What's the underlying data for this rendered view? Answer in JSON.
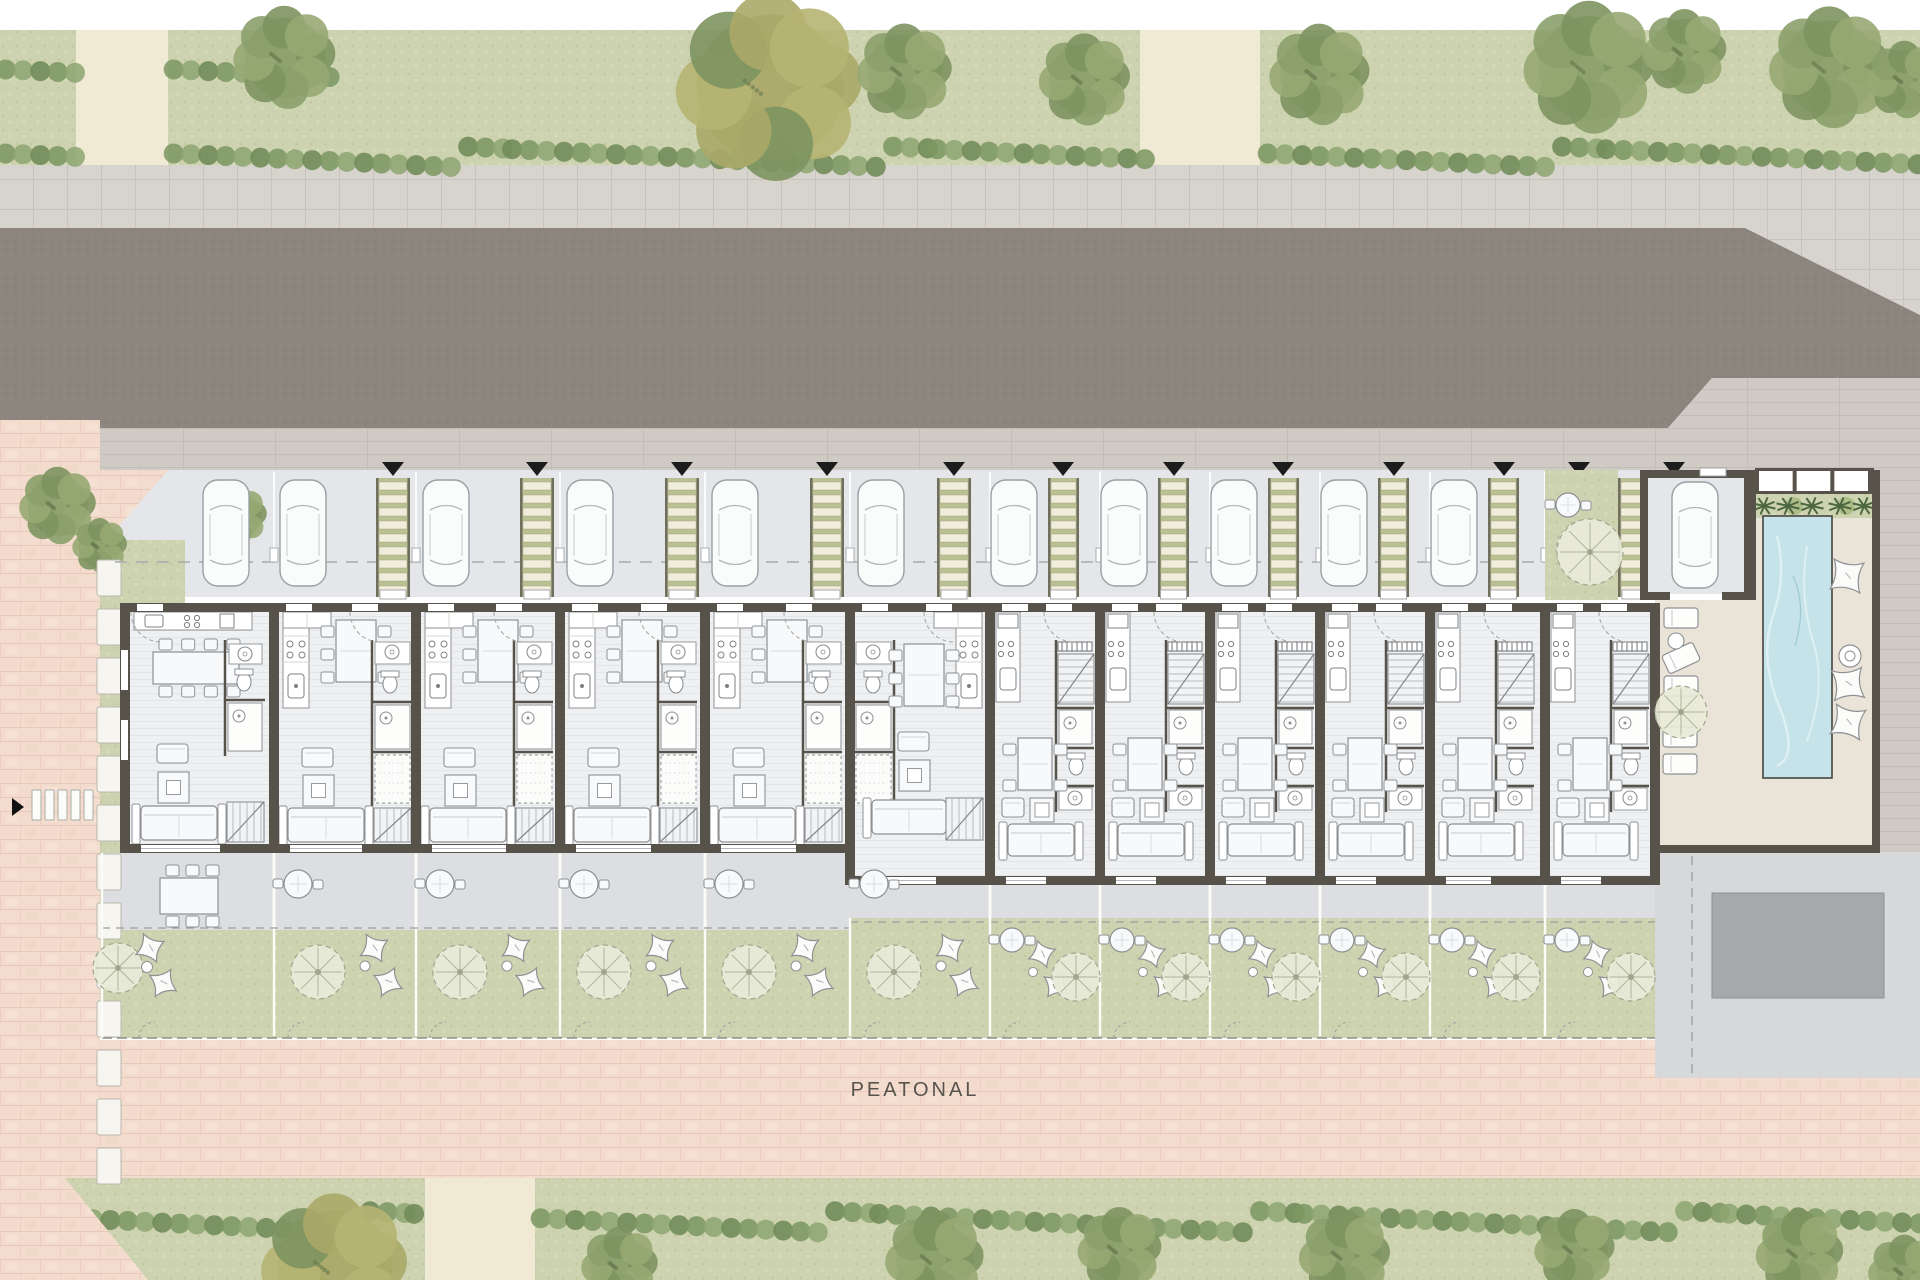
{
  "labels": {
    "pedestrian_street": "PEATONAL"
  },
  "palette": {
    "white": "#ffffff",
    "grass_base": "#cdd3b0",
    "grass_dot1": "#c1c8a0",
    "grass_dot2": "#dbe0bc",
    "hedge1": "#7d9763",
    "hedge2": "#8fa673",
    "hedge3": "#6f8a58",
    "tree_green1": "#8ba06b",
    "tree_green2": "#7d9460",
    "tree_green3": "#97a973",
    "tree_yellow": "#aaa868",
    "path_beige": "#f0e9d4",
    "sidewalk": "#d7d3cd",
    "sidewalk_line": "#c8c3bc",
    "road": "#8b857e",
    "road_dot1": "#96908a",
    "road_dot2": "#817b74",
    "apron": "#cfcbc4",
    "apron_line": "#c2bdb6",
    "parking_bg": "#e4e6e9",
    "walkway_green": "#b9c091",
    "walkway_slat": "#f1eddc",
    "walkway_rail": "#6f6f5e",
    "triangle": "#1c1c1c",
    "wall": "#57524a",
    "floor": "#eef0f2",
    "floor_line": "#e3e6e9",
    "furniture_fill": "#f8f9fa",
    "furniture_line": "#8e9194",
    "furniture_dark": "#6f7275",
    "terrace": "#dcdee1",
    "tree_wheel_fill": "#e8ead8",
    "tree_wheel_line": "#a0a68e",
    "pink": "#f3dccd",
    "pink_line": "#e7c9ba",
    "pink_light": "#f7e6da",
    "pool_water": "#c5e3e9",
    "pool_wave": "#def0f3",
    "pool_deep": "#9ccbd4",
    "deck": "#eae3d8",
    "palm_dark": "#4c6741",
    "palm_light": "#a9b883",
    "communal": "#d6d8da",
    "ramp": "#a6a8aa",
    "fence_white": "#fbfbf8",
    "dash_line": "#9a9d9f"
  },
  "site": {
    "units": [
      {
        "id": "unit-1",
        "type": "A1",
        "x": 125,
        "w": 149,
        "bottom": 853,
        "car_x": 203,
        "walk": null,
        "tri": null
      },
      {
        "id": "unit-2",
        "type": "A",
        "x": 274,
        "w": 142,
        "bottom": 853,
        "car_x": 280,
        "walk": [
          376,
          34
        ],
        "tri": 393
      },
      {
        "id": "unit-3",
        "type": "A",
        "x": 416,
        "w": 144,
        "bottom": 853,
        "car_x": 423,
        "walk": [
          520,
          34
        ],
        "tri": 537
      },
      {
        "id": "unit-4",
        "type": "A",
        "x": 560,
        "w": 145,
        "bottom": 853,
        "car_x": 567,
        "walk": [
          665,
          34
        ],
        "tri": 682
      },
      {
        "id": "unit-5",
        "type": "A",
        "x": 705,
        "w": 145,
        "bottom": 853,
        "car_x": 712,
        "walk": [
          810,
          34
        ],
        "tri": 827
      },
      {
        "id": "unit-6",
        "type": "AM",
        "x": 850,
        "w": 140,
        "bottom": 885,
        "car_x": 858,
        "walk": [
          937,
          34
        ],
        "tri": 954
      },
      {
        "id": "unit-7",
        "type": "B",
        "x": 990,
        "w": 110,
        "bottom": 885,
        "car_x": 991,
        "walk": [
          1048,
          31
        ],
        "tri": 1063
      },
      {
        "id": "unit-8",
        "type": "B",
        "x": 1100,
        "w": 110,
        "bottom": 885,
        "car_x": 1101,
        "walk": [
          1158,
          31
        ],
        "tri": 1174
      },
      {
        "id": "unit-9",
        "type": "B",
        "x": 1210,
        "w": 110,
        "bottom": 885,
        "car_x": 1211,
        "walk": [
          1268,
          31
        ],
        "tri": 1283
      },
      {
        "id": "unit-10",
        "type": "B",
        "x": 1320,
        "w": 110,
        "bottom": 885,
        "car_x": 1321,
        "walk": [
          1378,
          31
        ],
        "tri": 1394
      },
      {
        "id": "unit-11",
        "type": "B",
        "x": 1430,
        "w": 115,
        "bottom": 885,
        "car_x": 1431,
        "walk": [
          1488,
          31
        ],
        "tri": 1504
      },
      {
        "id": "unit-12",
        "type": "B",
        "x": 1545,
        "w": 110,
        "bottom": 885,
        "car_x": null,
        "walk": [
          1618,
          34
        ],
        "tri": null
      }
    ],
    "building": {
      "left": 125,
      "right": 1655,
      "top": 603,
      "bottom_a": 853,
      "bottom_b": 885,
      "step_x": 850
    },
    "parking": {
      "y": 470,
      "h": 127,
      "dash_y": 562,
      "extra_triangles": [
        1579,
        1674
      ]
    },
    "terrace_a": {
      "y": 853,
      "h": 77
    },
    "terrace_b": {
      "y": 885,
      "h": 33
    },
    "garden": {
      "bottom": 1038
    },
    "courtyard": {
      "x": 1545,
      "w": 73,
      "y": 470,
      "h": 130,
      "bistro": [
        1568,
        505
      ],
      "tree": [
        1590,
        552,
        33
      ]
    },
    "carport": {
      "x": 1640,
      "y": 470,
      "w": 112,
      "h": 130,
      "car": [
        1672,
        482
      ]
    }
  },
  "pool_area": {
    "pergola": {
      "x": 1755,
      "y": 468,
      "w": 119,
      "h": 26,
      "cells": 3
    },
    "planting": {
      "x": 1755,
      "y": 494,
      "w": 117,
      "h": 24,
      "palms": [
        1764,
        1788,
        1812,
        1840,
        1864
      ]
    },
    "pool": {
      "x": 1763,
      "y": 516,
      "w": 69,
      "h": 262
    },
    "left_loungers": [
      [
        1664,
        608,
        0
      ],
      [
        1664,
        648,
        -25
      ],
      [
        1664,
        676,
        0
      ],
      [
        1663,
        727,
        0
      ],
      [
        1663,
        754,
        0
      ]
    ],
    "side_table": [
      1676,
      641,
      8
    ],
    "deck_tree": [
      1681,
      712,
      26
    ],
    "pillows": [
      [
        1847,
        576,
        8
      ],
      [
        1848,
        684,
        -6
      ],
      [
        1848,
        722,
        12
      ]
    ],
    "ring_table": [
      1850,
      656,
      11
    ],
    "ramp": {
      "x": 1712,
      "y": 893,
      "w": 172,
      "h": 105
    },
    "dash_x": 1692
  },
  "landscape": {
    "top_strip": {
      "y": 30,
      "h": 135,
      "paths": [
        [
          76,
          92
        ],
        [
          1140,
          120
        ]
      ]
    },
    "top_hedges": [
      {
        "y": 52,
        "h": 42,
        "segs": [
          [
            0,
            74
          ],
          [
            168,
            330
          ]
        ]
      },
      {
        "y": 136,
        "h": 42,
        "segs": [
          [
            0,
            74
          ],
          [
            168,
            1138
          ],
          [
            1262,
            1920
          ]
        ]
      }
    ],
    "top_trees": [
      [
        285,
        58,
        56,
        "g"
      ],
      [
        770,
        88,
        102,
        "y"
      ],
      [
        905,
        72,
        52,
        "g"
      ],
      [
        1085,
        80,
        50,
        "g"
      ],
      [
        1320,
        75,
        55,
        "g"
      ],
      [
        1590,
        68,
        72,
        "g"
      ],
      [
        1685,
        52,
        46,
        "g"
      ],
      [
        1830,
        68,
        66,
        "g"
      ],
      [
        1905,
        80,
        42,
        "g"
      ]
    ],
    "bottom_strip": {
      "y": 1178,
      "h": 102,
      "path": [
        425,
        110
      ]
    },
    "bottom_hedges": [
      {
        "y": 1200,
        "h": 44,
        "segs": [
          [
            70,
            425
          ],
          [
            535,
            1920
          ]
        ]
      }
    ],
    "bottom_trees": [
      [
        335,
        1268,
        80,
        "y"
      ],
      [
        620,
        1266,
        42,
        "g"
      ],
      [
        935,
        1260,
        54,
        "g"
      ],
      [
        1120,
        1250,
        46,
        "g"
      ],
      [
        1345,
        1256,
        50,
        "g"
      ],
      [
        1575,
        1250,
        44,
        "g"
      ],
      [
        1800,
        1254,
        48,
        "g"
      ],
      [
        1905,
        1272,
        40,
        "g"
      ]
    ],
    "pink_wedge": [
      [
        0,
        1178
      ],
      [
        65,
        1178
      ],
      [
        148,
        1280
      ],
      [
        0,
        1280
      ]
    ],
    "misc_trees": [
      [
        58,
        506,
        42
      ],
      [
        100,
        546,
        30
      ],
      [
        238,
        516,
        32
      ],
      [
        150,
        728,
        38
      ]
    ],
    "stones": {
      "x": 97,
      "w": 24,
      "h": 36,
      "gap": 13,
      "y0": 560,
      "n": 13
    },
    "crosswalk": {
      "x": 32,
      "y": 790,
      "n": 5,
      "w": 9,
      "h": 30,
      "gap": 13
    },
    "arrow": {
      "x": 12,
      "y": 798,
      "h": 18,
      "len": 12
    }
  }
}
